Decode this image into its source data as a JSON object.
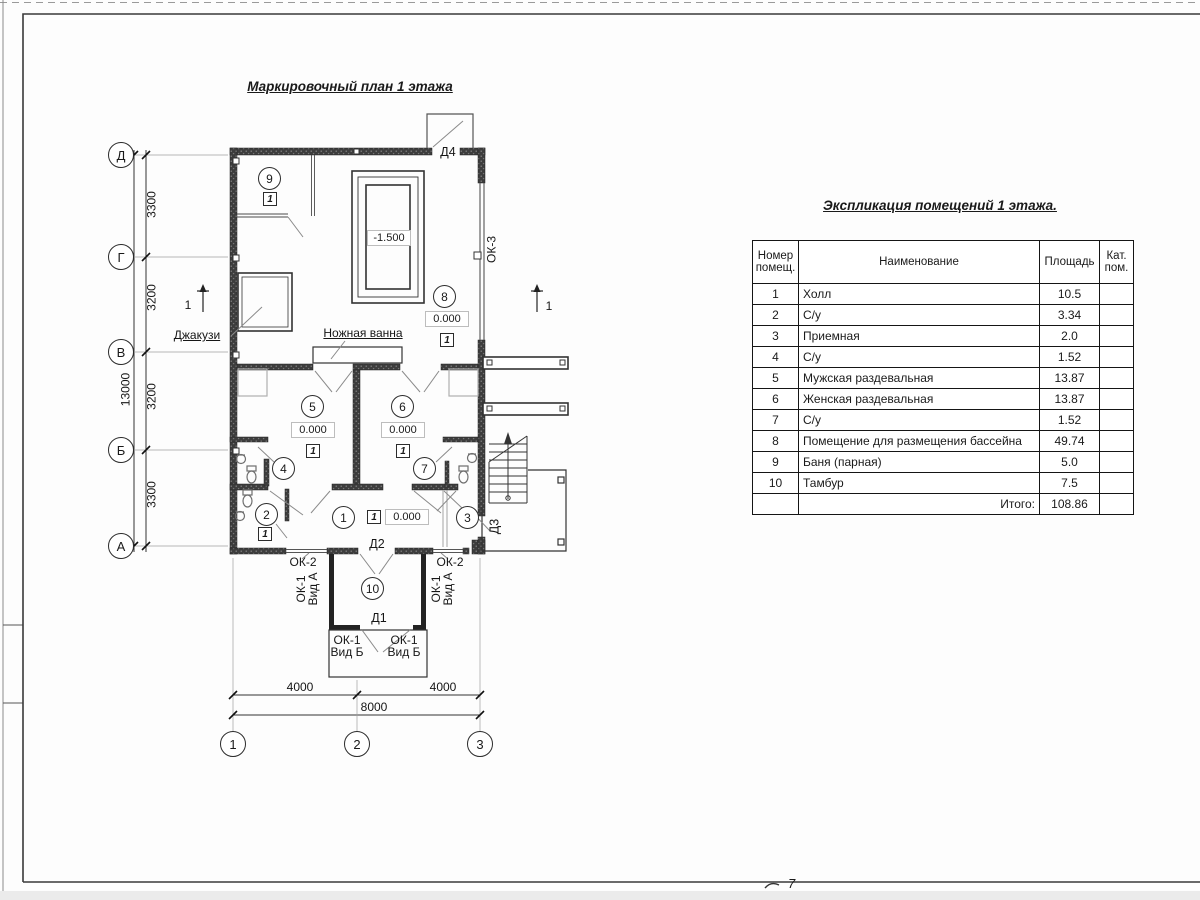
{
  "page": {
    "number_mark": "7"
  },
  "plan": {
    "title": "Маркировочный план 1 этажа",
    "grid": {
      "rows": [
        "Д",
        "Г",
        "В",
        "Б",
        "А"
      ],
      "cols": [
        "1",
        "2",
        "3"
      ]
    },
    "dimensions": {
      "left_segments": [
        "3300",
        "3200",
        "3200",
        "3300"
      ],
      "left_total": "13000",
      "bottom_segments": [
        "4000",
        "4000"
      ],
      "bottom_total": "8000"
    },
    "levels": {
      "pool": "-1.500",
      "main": "0.000"
    },
    "rooms": [
      "1",
      "2",
      "3",
      "4",
      "5",
      "6",
      "7",
      "8",
      "9",
      "10"
    ],
    "floor_type": "1",
    "doors": {
      "d1": "Д1",
      "d2": "Д2",
      "d3": "Д3",
      "d4": "Д4"
    },
    "windows": {
      "ok3": "ОК-3",
      "ok2": "ОК-2",
      "ok1": "ОК-1",
      "vid_a": "Вид А",
      "vid_b": "Вид Б"
    },
    "annotations": {
      "jacuzzi": "Джакузи",
      "foot_bath": "Ножная ванна",
      "section_mark": "1"
    }
  },
  "table": {
    "title": "Экспликация помещений 1 этажа.",
    "headers": {
      "num": "Номер помещ.",
      "name": "Наименование",
      "area": "Площадь",
      "cat": "Кат. пом."
    },
    "rows": [
      {
        "num": "1",
        "name": "Холл",
        "area": "10.5"
      },
      {
        "num": "2",
        "name": "С/у",
        "area": "3.34"
      },
      {
        "num": "3",
        "name": "Приемная",
        "area": "2.0"
      },
      {
        "num": "4",
        "name": "С/у",
        "area": "1.52"
      },
      {
        "num": "5",
        "name": "Мужская раздевальная",
        "area": "13.87"
      },
      {
        "num": "6",
        "name": "Женская раздевальная",
        "area": "13.87"
      },
      {
        "num": "7",
        "name": "С/у",
        "area": "1.52"
      },
      {
        "num": "8",
        "name": "Помещение для размещения бассейна",
        "area": "49.74"
      },
      {
        "num": "9",
        "name": "Баня (парная)",
        "area": "5.0"
      },
      {
        "num": "10",
        "name": "Тамбур",
        "area": "7.5"
      }
    ],
    "total_label": "Итого:",
    "total_value": "108.86"
  }
}
